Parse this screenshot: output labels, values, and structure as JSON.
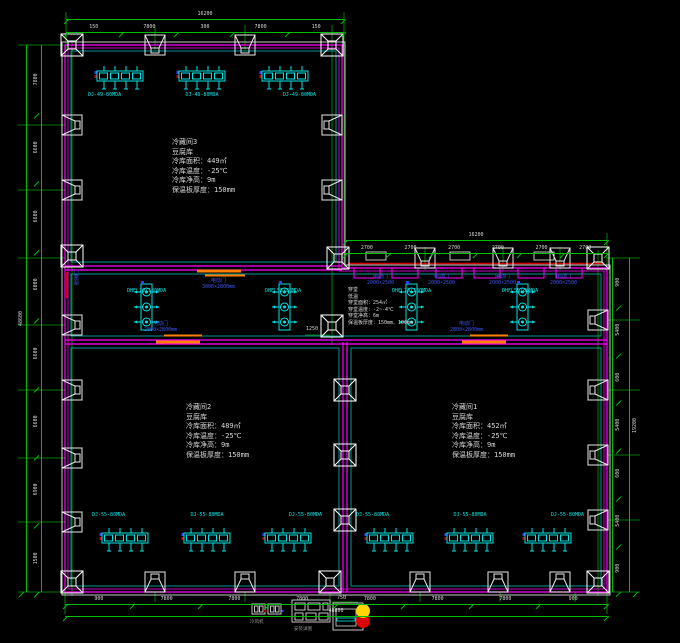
{
  "rooms": {
    "room3": {
      "lines": [
        "冷藏间3",
        "豆腐库",
        "冷库面积：449㎡",
        "冷库温度：-25℃",
        "冷库净高：9m",
        "保温板厚度：150mm"
      ]
    },
    "room2": {
      "lines": [
        "冷藏间2",
        "豆腐库",
        "冷库面积：489㎡",
        "冷库温度：-25℃",
        "冷库净高：9m",
        "保温板厚度：150mm"
      ]
    },
    "room1": {
      "lines": [
        "冷藏间1",
        "豆腐库",
        "冷库面积：452㎡",
        "冷库温度：-25℃",
        "冷库净高：9m",
        "保温板厚度：150mm"
      ]
    },
    "corridor_note": {
      "lines": [
        "穿堂",
        "低温",
        "穿堂面积：254㎡",
        "穿堂温度：-2~-4℃",
        "穿堂净高：6m",
        "保温板厚度：150mm、100mm"
      ]
    }
  },
  "equipment": {
    "top_labels": [
      "DJ-49-80MDA",
      "DJ-49-80MDA",
      "DJ-49-80MDA"
    ],
    "bottom_left_labels": [
      "DJ-55-80MDA",
      "DJ-55-80MDA",
      "DJ-55-80MDA"
    ],
    "bottom_right_labels": [
      "DJ-55-80MDA",
      "DJ-55-80MDA",
      "DJ-55-80MDA"
    ],
    "corridor_unit_labels": [
      "DHFL70/100MDA",
      "DHFL55/80MDA",
      "DHFL70/100MDA",
      "DHFL55/80MDA"
    ]
  },
  "doors": {
    "top": {
      "line1": "电动门",
      "line2": "3000×2800mm"
    },
    "bottom_left": {
      "line1": "电动门",
      "line2": "2800×2800mm"
    },
    "bottom_right": {
      "line1": "电动门",
      "line2": "2800×2800mm"
    },
    "left": {
      "line1": "保温门"
    },
    "dock_doors": [
      {
        "line1": "电动门",
        "line2": "2000×2500"
      },
      {
        "line1": "电动门",
        "line2": "2000×2500"
      },
      {
        "line1": "电动门",
        "line2": "2000×2500"
      },
      {
        "line1": "电动门",
        "line2": "2000×2500"
      }
    ]
  },
  "dims": {
    "top": {
      "overall": "16200",
      "segments": [
        "150",
        "7800",
        "300",
        "7800",
        "150"
      ]
    },
    "ext_top": {
      "overall": "16200",
      "segments": [
        "2700",
        "2700",
        "2700",
        "2700",
        "2700",
        "2700"
      ]
    },
    "left": {
      "overall": "48600",
      "segments": [
        "7800",
        "6600",
        "6600",
        "6000",
        "6600",
        "6600",
        "6900",
        "1500"
      ]
    },
    "bottom": {
      "overall": "48600",
      "segments": [
        "900",
        "7800",
        "7800",
        "7800",
        "7800",
        "7800",
        "7800",
        "900"
      ]
    },
    "right": {
      "overall": "19200",
      "segments": [
        "900",
        "5400",
        "600",
        "5400",
        "600",
        "5400",
        "900"
      ]
    },
    "interior": {
      "mid_column": "1250",
      "legend": "750"
    }
  },
  "legend": {
    "item1_label": "冷风机",
    "item2_label": "安装详图"
  }
}
